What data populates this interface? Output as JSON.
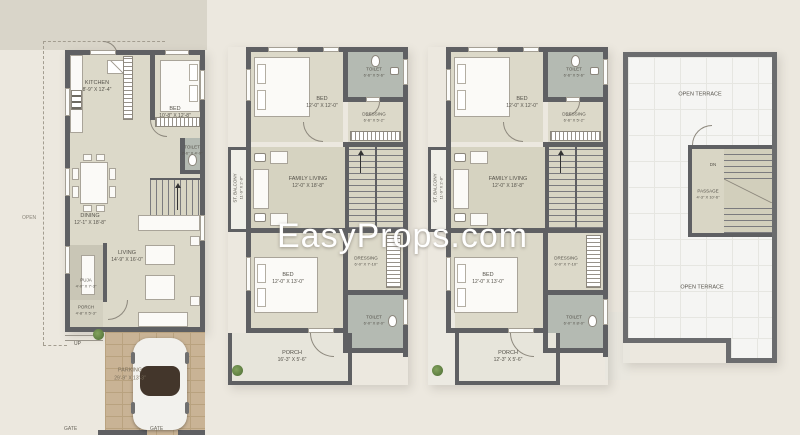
{
  "watermark": {
    "text": "EasyProps.com",
    "color": "#ffffff"
  },
  "colors": {
    "background": "#ece8df",
    "wall": "#5f6063",
    "toilet_floor": "#b4bab2",
    "room_light": "#dcd9c9",
    "room_olive": "#d6d3c1",
    "parking_brick": "#c9b395",
    "terrace_floor": "#f5f5f3",
    "watermark": "#ffffff"
  },
  "plans": {
    "ground": {
      "open_label": "OPEN",
      "up_label": "UP",
      "gate_left": "GATE",
      "gate_right": "GATE",
      "rooms": {
        "kitchen": {
          "name": "KITCHEN",
          "dims": "8'-9\" X 12'-4\""
        },
        "bed": {
          "name": "BED",
          "dims": "10'-8\" X 12'-8\""
        },
        "toilet": {
          "name": "TOILET",
          "dims": "2'-6\" X 4'-0\""
        },
        "dining": {
          "name": "DINING",
          "dims": "12'-1\" X 18'-8\""
        },
        "living": {
          "name": "LIVING",
          "dims": "14'-9\" X 16'-0\""
        },
        "puja": {
          "name": "PUJA",
          "dims": "4'-0\" X 7'-3\""
        },
        "porch": {
          "name": "PORCH",
          "dims": "4'-8\" X 5'-3\""
        },
        "parking": {
          "name": "PARKING",
          "dims": "29'-9\" X 13'-3\""
        }
      }
    },
    "first": {
      "rooms": {
        "bed_top": {
          "name": "BED",
          "dims": "12'-0\" X 12'-0\""
        },
        "toilet_top": {
          "name": "TOILET",
          "dims": "6'-6\" X 5'-6\""
        },
        "dressing_top": {
          "name": "DRESSING",
          "dims": "6'-6\" X 5'-2\""
        },
        "family_living": {
          "name": "FAMILY LIVING",
          "dims": "12'-0\" X 18'-8\""
        },
        "st_balcony": {
          "name": "ST. BALCONY",
          "dims": "11'-9\" X 2'-8\""
        },
        "dressing_bottom": {
          "name": "DRESSING",
          "dims": "6'-0\" X 7'-10\""
        },
        "bed_bottom": {
          "name": "BED",
          "dims": "12'-0\" X 13'-0\""
        },
        "toilet_bottom": {
          "name": "TOILET",
          "dims": "6'-0\" X 8'-0\""
        },
        "porch": {
          "name": "PORCH",
          "dims": "16'-3\" X 5'-6\""
        }
      }
    },
    "second": {
      "rooms": {
        "bed_top": {
          "name": "BED",
          "dims": "12'-0\" X 12'-0\""
        },
        "toilet_top": {
          "name": "TOILET",
          "dims": "6'-6\" X 5'-6\""
        },
        "dressing_top": {
          "name": "DRESSING",
          "dims": "6'-6\" X 5'-2\""
        },
        "family_living": {
          "name": "FAMILY LIVING",
          "dims": "12'-0\" X 18'-8\""
        },
        "st_balcony": {
          "name": "ST. BALCONY",
          "dims": "11'-9\" X 2'-8\""
        },
        "dressing_bottom": {
          "name": "DRESSING",
          "dims": "6'-0\" X 7'-10\""
        },
        "bed_bottom": {
          "name": "BED",
          "dims": "12'-0\" X 13'-0\""
        },
        "toilet_bottom": {
          "name": "TOILET",
          "dims": "6'-0\" X 8'-0\""
        },
        "porch": {
          "name": "PORCH",
          "dims": "12'-3\" X 5'-6\""
        }
      }
    },
    "terrace": {
      "open_terrace_top": "OPEN TERRACE",
      "open_terrace_bottom": "OPEN TERRACE",
      "dn_label": "DN",
      "rooms": {
        "passage": {
          "name": "PASSAGE",
          "dims": "4'-3\" X 10'-6\""
        }
      }
    }
  }
}
